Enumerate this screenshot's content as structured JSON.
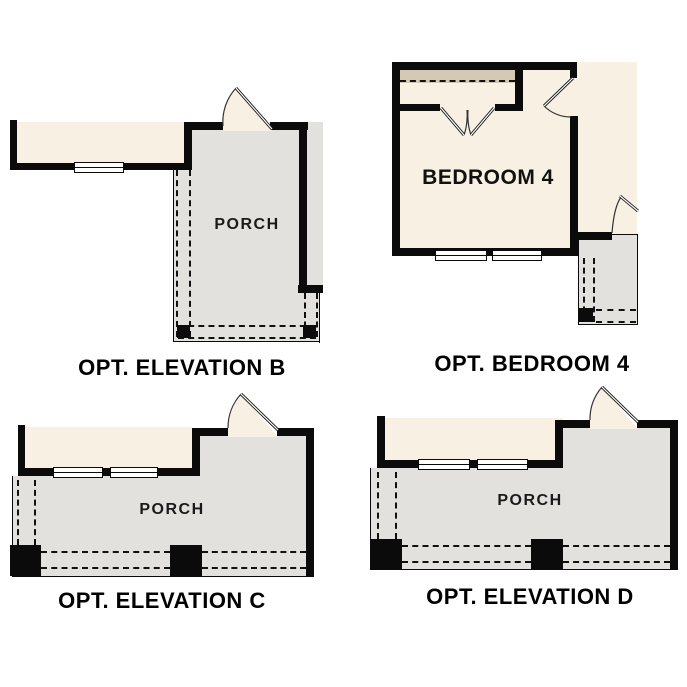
{
  "sheet": {
    "background": "#ffffff",
    "colors": {
      "wall": "#0b0b0b",
      "floor_cream": "#f7f0e3",
      "porch_gray": "#e2e1de",
      "closet_tan": "#d3c9b4",
      "text": "#000000"
    }
  },
  "plans": {
    "elevation_b": {
      "caption": "OPT. ELEVATION B",
      "porch_label": "PORCH"
    },
    "bedroom_4": {
      "caption": "OPT. BEDROOM 4",
      "room_label": "BEDROOM 4"
    },
    "elevation_c": {
      "caption": "OPT. ELEVATION C",
      "porch_label": "PORCH"
    },
    "elevation_d": {
      "caption": "OPT. ELEVATION D",
      "porch_label": "PORCH"
    }
  }
}
